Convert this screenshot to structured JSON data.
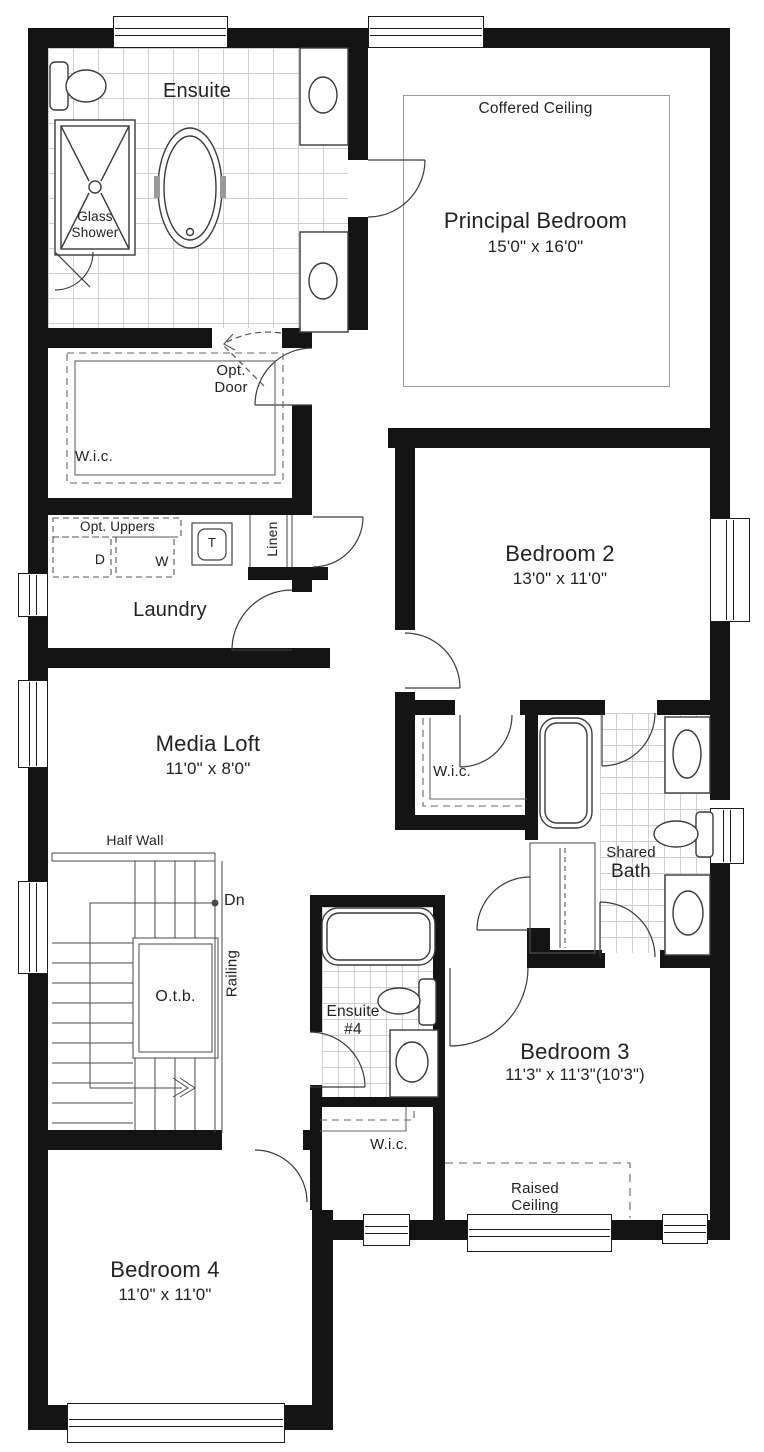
{
  "plan": {
    "rooms": {
      "ensuite": {
        "name": "Ensuite"
      },
      "principal": {
        "name": "Principal Bedroom",
        "dims": "15'0\" x 16'0\"",
        "ceiling": "Coffered Ceiling"
      },
      "wic_principal": {
        "name": "W.i.c."
      },
      "laundry": {
        "name": "Laundry",
        "opt_uppers": "Opt. Uppers",
        "dryer": "D",
        "washer": "W",
        "tub": "T"
      },
      "linen": {
        "name": "Linen"
      },
      "bedroom2": {
        "name": "Bedroom 2",
        "dims": "13'0\" x 11'0\""
      },
      "media_loft": {
        "name": "Media Loft",
        "dims": "11'0\" x 8'0\""
      },
      "wic_bedroom2": {
        "name": "W.i.c."
      },
      "shared_bath": {
        "name_line1": "Shared",
        "name_line2": "Bath"
      },
      "ensuite4": {
        "name_line1": "Ensuite",
        "name_line2": "#4"
      },
      "bedroom3": {
        "name": "Bedroom 3",
        "dims": "11'3\" x 11'3\"(10'3\")",
        "ceiling_line1": "Raised",
        "ceiling_line2": "Ceiling"
      },
      "wic_bedroom3": {
        "name": "W.i.c."
      },
      "bedroom4": {
        "name": "Bedroom 4",
        "dims": "11'0\" x 11'0\""
      }
    },
    "fixtures": {
      "glass_shower_line1": "Glass",
      "glass_shower_line2": "Shower"
    },
    "stairs": {
      "half_wall": "Half Wall",
      "down": "Dn",
      "railing": "Railing",
      "open_to_below": "O.t.b."
    },
    "doors": {
      "optional_line1": "Opt.",
      "optional_line2": "Door"
    },
    "colors": {
      "wall": "#141414",
      "text": "#222222",
      "tile_line": "#cfcfcf",
      "fixture_line": "#3a3a3a",
      "dashed": "#666666"
    }
  }
}
